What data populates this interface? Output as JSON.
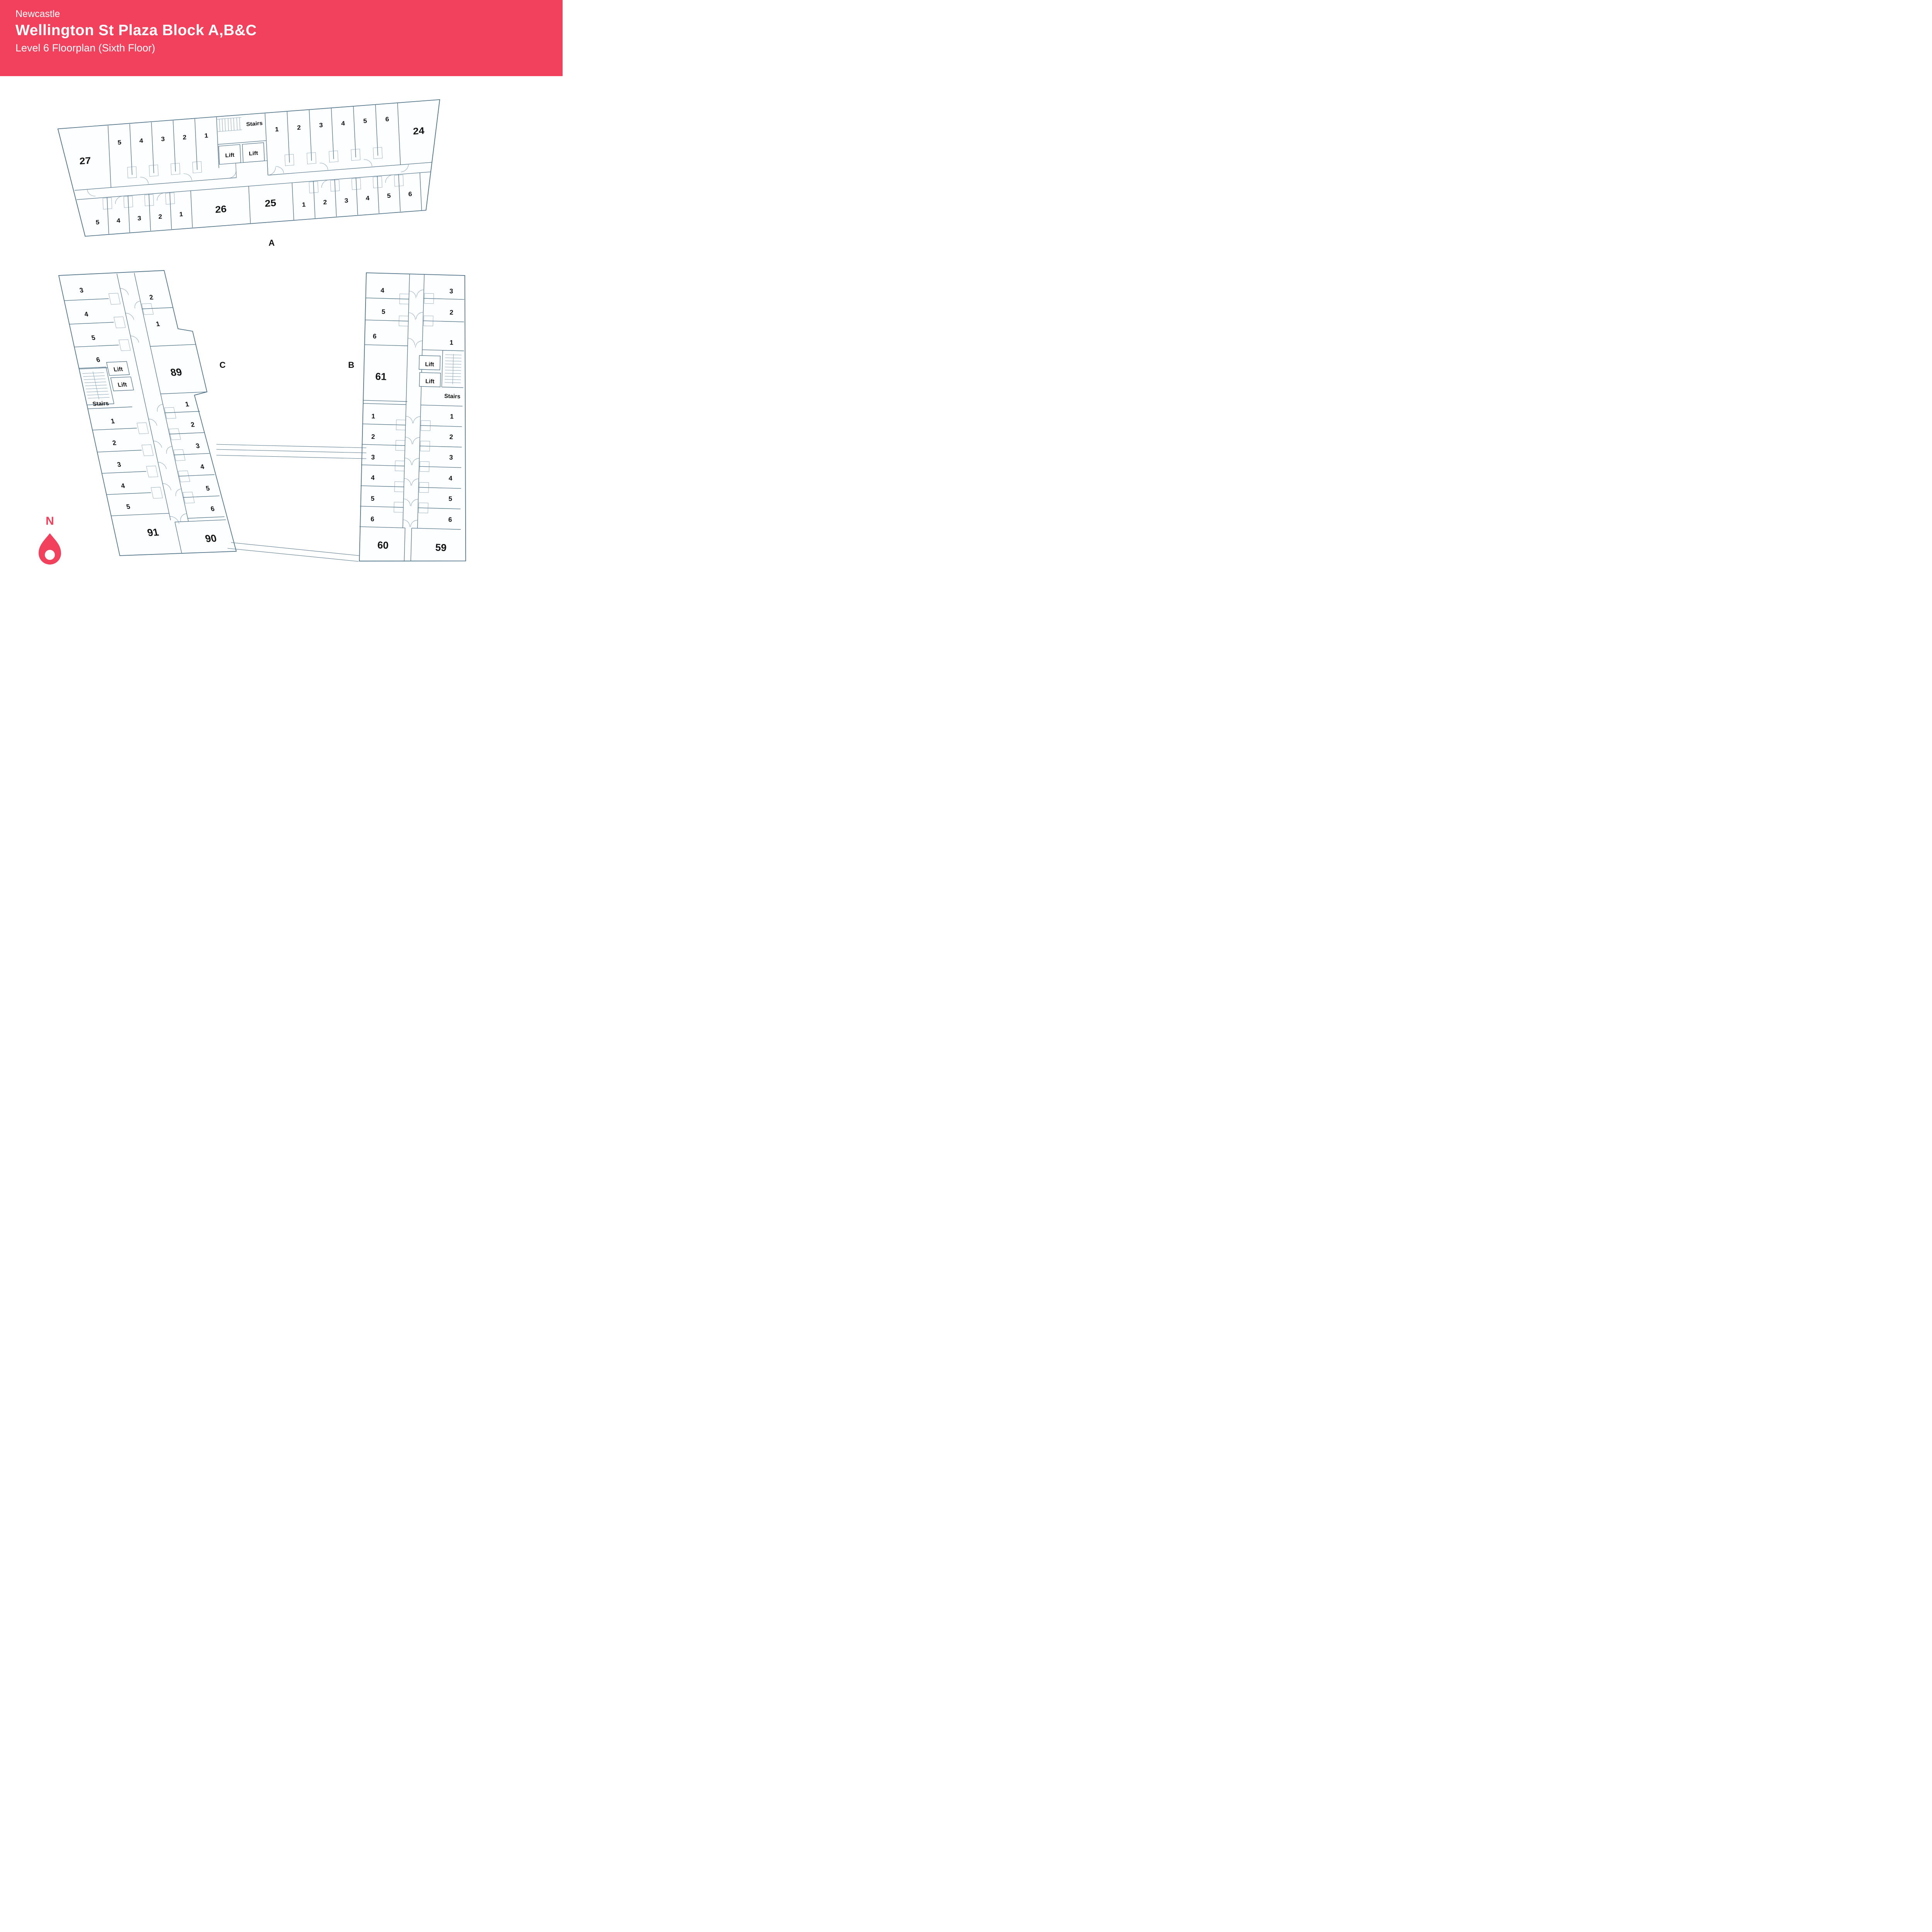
{
  "header": {
    "city": "Newcastle",
    "title": "Wellington St Plaza Block A,B&C",
    "subtitle": "Level 6 Floorplan (Sixth Floor)",
    "bg_color": "#F2415C",
    "text_color": "#FFFFFF"
  },
  "plan_style": {
    "wall_color": "#4D7187",
    "label_color": "#121212",
    "accent_color": "#F2415C"
  },
  "north": {
    "label": "N"
  },
  "blocks": {
    "A": {
      "label": "A",
      "room_27": "27",
      "room_26": "26",
      "room_25": "25",
      "room_24": "24",
      "top_left_rooms": [
        "5",
        "4",
        "3",
        "2",
        "1"
      ],
      "top_right_rooms": [
        "1",
        "2",
        "3",
        "4",
        "5",
        "6"
      ],
      "bottom_left_rooms": [
        "5",
        "4",
        "3",
        "2",
        "1"
      ],
      "bottom_right_rooms": [
        "1",
        "2",
        "3",
        "4",
        "5",
        "6"
      ],
      "stairs": "Stairs",
      "lift1": "Lift",
      "lift2": "Lift"
    },
    "C": {
      "label": "C",
      "room_89": "89",
      "room_91": "91",
      "room_90": "90",
      "top_left_rooms": [
        "3",
        "4",
        "5",
        "6"
      ],
      "top_right_rooms": [
        "2",
        "1"
      ],
      "bottom_left_rooms": [
        "1",
        "2",
        "3",
        "4",
        "5"
      ],
      "bottom_right_rooms": [
        "1",
        "2",
        "3",
        "4",
        "5",
        "6"
      ],
      "stairs": "Stairs",
      "lift1": "Lift",
      "lift2": "Lift"
    },
    "B": {
      "label": "B",
      "room_61": "61",
      "room_60": "60",
      "room_59": "59",
      "top_left_rooms": [
        "4",
        "5",
        "6"
      ],
      "top_right_rooms": [
        "3",
        "2",
        "1"
      ],
      "bottom_left_rooms": [
        "1",
        "2",
        "3",
        "4",
        "5",
        "6"
      ],
      "bottom_right_rooms": [
        "1",
        "2",
        "3",
        "4",
        "5",
        "6"
      ],
      "stairs": "Stairs",
      "lift1": "Lift",
      "lift2": "Lift"
    }
  }
}
